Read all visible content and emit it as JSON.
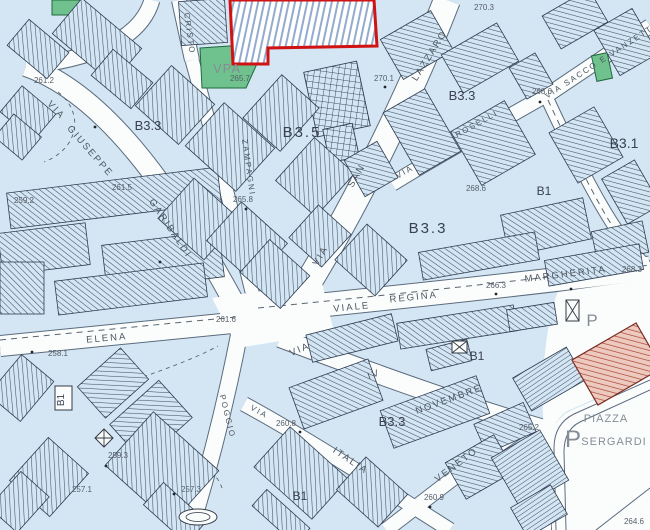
{
  "map": {
    "title": "urban-zoning-map",
    "colors": {
      "block_fill": "#d4e6f3",
      "hatch_line": "#3e4e64",
      "street": "#fbfdfd",
      "street_edge": "#5b6b7d",
      "building_outline": "#2e3c50",
      "green_area": "#6fc28e",
      "green_edge": "#20683f",
      "red_plan_outline": "#d01212",
      "blue_stripe": "#93abce",
      "red_building_fill": "#eccabf",
      "red_building_line": "#a83a28",
      "label_dark": "#39414e",
      "label_mid": "#4c555f",
      "label_light": "#565e68",
      "label_gray": "#858c95"
    },
    "zone_labels": [
      {
        "text": "B3.3",
        "x": 148,
        "y": 130,
        "size": 13
      },
      {
        "text": "B3.5",
        "x": 302,
        "y": 137,
        "size": 15,
        "ls": 2
      },
      {
        "text": "B3.3",
        "x": 462,
        "y": 100,
        "size": 13
      },
      {
        "text": "B3.3",
        "x": 428,
        "y": 233,
        "size": 15,
        "ls": 2
      },
      {
        "text": "B3.1",
        "x": 624,
        "y": 148,
        "size": 14
      },
      {
        "text": "B1",
        "x": 544,
        "y": 195,
        "size": 12
      },
      {
        "text": "B1",
        "x": 477,
        "y": 360,
        "size": 12
      },
      {
        "text": "B3.3",
        "x": 392,
        "y": 426,
        "size": 13
      },
      {
        "text": "B1",
        "x": 64,
        "y": 400,
        "size": 10,
        "rot": -90
      },
      {
        "text": "B1",
        "x": 300,
        "y": 500,
        "size": 12
      }
    ],
    "street_labels": [
      {
        "text": "VIA",
        "x": 54,
        "y": 112,
        "rot": 48
      },
      {
        "text": "GIUSEPPE",
        "x": 88,
        "y": 153,
        "rot": 49
      },
      {
        "text": "GARIBALDI",
        "x": 168,
        "y": 230,
        "rot": 56
      },
      {
        "text": "CRISTO",
        "x": 187,
        "y": 34,
        "rot": 82,
        "size": 8,
        "ls": 1
      },
      {
        "text": "ZAMPAGNI",
        "x": 246,
        "y": 168,
        "rot": 82,
        "size": 8,
        "ls": 1
      },
      {
        "text": "VIA",
        "x": 323,
        "y": 257,
        "rot": -60
      },
      {
        "text": "SAN",
        "x": 359,
        "y": 177,
        "rot": -60
      },
      {
        "text": "LAZZARO",
        "x": 432,
        "y": 57,
        "rot": -58
      },
      {
        "text": "VIA",
        "x": 406,
        "y": 174,
        "rot": -30,
        "size": 8
      },
      {
        "text": "ROSELLI",
        "x": 478,
        "y": 126,
        "rot": -29,
        "size": 8
      },
      {
        "text": "VIA  SACCO  E VANZETTI",
        "x": 602,
        "y": 63,
        "rot": -33,
        "size": 8,
        "ls": 0.8
      },
      {
        "text": "VIALE",
        "x": 352,
        "y": 310,
        "rot": -6
      },
      {
        "text": "REGINA",
        "x": 414,
        "y": 300,
        "rot": -6
      },
      {
        "text": "MARGHERITA",
        "x": 566,
        "y": 277,
        "rot": -7
      },
      {
        "text": "ELENA",
        "x": 107,
        "y": 341,
        "rot": -5
      },
      {
        "text": "VIA",
        "x": 301,
        "y": 352,
        "rot": -23
      },
      {
        "text": "IV",
        "x": 375,
        "y": 377,
        "rot": -21
      },
      {
        "text": "NOVEMBRE",
        "x": 450,
        "y": 402,
        "rot": -20
      },
      {
        "text": "POGGIO",
        "x": 225,
        "y": 417,
        "rot": 76,
        "size": 8,
        "ls": 1
      },
      {
        "text": "VIA",
        "x": 258,
        "y": 414,
        "rot": 30,
        "size": 8
      },
      {
        "text": "ITALIA",
        "x": 349,
        "y": 463,
        "rot": 34
      },
      {
        "text": "VENETO",
        "x": 458,
        "y": 467,
        "rot": -37
      }
    ],
    "elevation_labels": [
      {
        "text": "261.2",
        "x": 44,
        "y": 83
      },
      {
        "text": "259.2",
        "x": 24,
        "y": 203
      },
      {
        "text": "261.5",
        "x": 122,
        "y": 190
      },
      {
        "text": "265.8",
        "x": 243,
        "y": 202
      },
      {
        "text": "270.3",
        "x": 484,
        "y": 10
      },
      {
        "text": "270.1",
        "x": 384,
        "y": 81
      },
      {
        "text": "268.6",
        "x": 542,
        "y": 94
      },
      {
        "text": "268.6",
        "x": 476,
        "y": 191
      },
      {
        "text": "268.3",
        "x": 632,
        "y": 272
      },
      {
        "text": "266.3",
        "x": 496,
        "y": 288
      },
      {
        "text": "261.6",
        "x": 226,
        "y": 322
      },
      {
        "text": "258.1",
        "x": 58,
        "y": 356
      },
      {
        "text": "265.2",
        "x": 529,
        "y": 430
      },
      {
        "text": "264.6",
        "x": 634,
        "y": 524
      },
      {
        "text": "260.8",
        "x": 286,
        "y": 426
      },
      {
        "text": "260.9",
        "x": 434,
        "y": 500
      },
      {
        "text": "259.3",
        "x": 118,
        "y": 458
      },
      {
        "text": "257.3",
        "x": 191,
        "y": 492
      },
      {
        "text": "257.1",
        "x": 82,
        "y": 492
      },
      {
        "text": "265.7",
        "x": 240,
        "y": 81,
        "size": 7
      }
    ],
    "area_labels": [
      {
        "text": "VPA",
        "x": 227,
        "y": 73,
        "size": 13,
        "color": "#1f5038",
        "ls": 1
      },
      {
        "text": "PIAZZA",
        "x": 606,
        "y": 422,
        "size": 11,
        "ls": 1
      },
      {
        "text": "SERGARDI",
        "x": 614,
        "y": 445,
        "size": 11,
        "ls": 1
      },
      {
        "text": "P",
        "x": 592,
        "y": 326,
        "size": 17
      },
      {
        "text": "P",
        "x": 573,
        "y": 447,
        "size": 24
      }
    ]
  }
}
